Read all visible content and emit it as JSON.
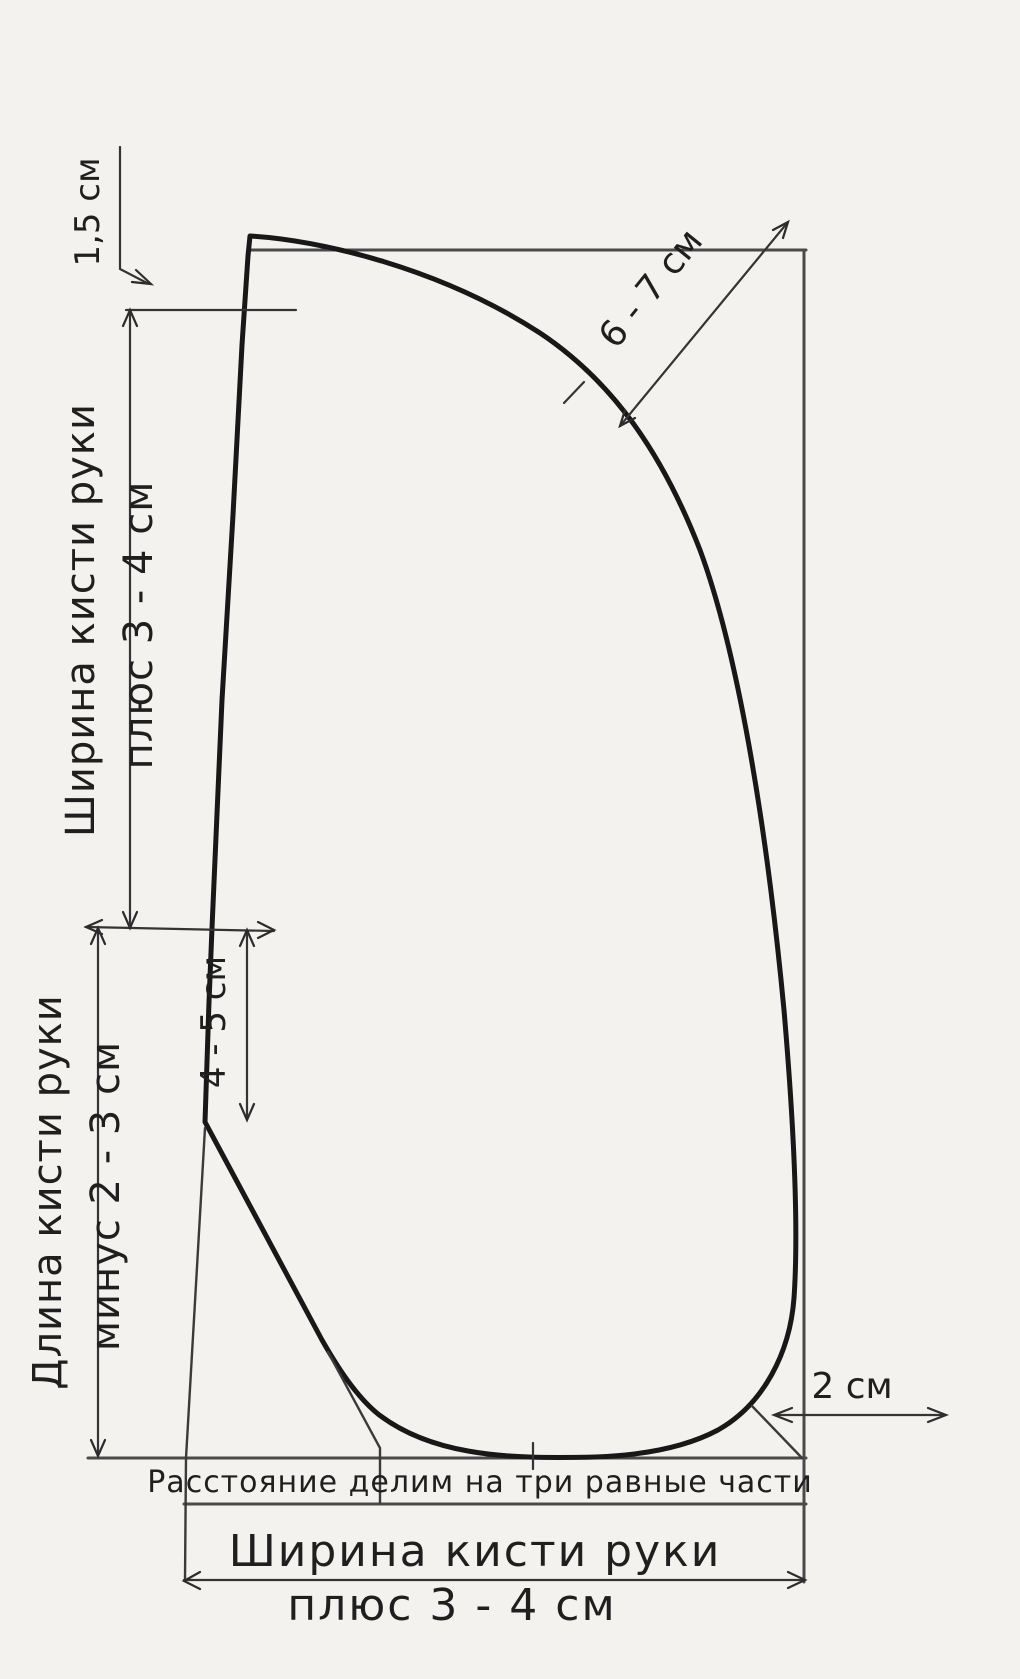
{
  "colors": {
    "background": "#f3f2ef",
    "pattern_outline": "#181818",
    "reference_lines": "#4a4a4a",
    "dimension_lines": "#343434",
    "text": "#1f1f1f"
  },
  "labels": {
    "offset_top": "1,5 см",
    "width_top": {
      "line1": "Ширина кисти руки",
      "line2": "плюс 3 - 4 см"
    },
    "corner_diagonal": "6 - 7 см",
    "notch_depth": "4 - 5 см",
    "hand_length": {
      "line1": "Длина кисти руки",
      "line2": "минус 2 - 3 см"
    },
    "corner_gap": "2 см",
    "divide_note": "Расстояние делим на три равные части",
    "width_bottom": {
      "line1": "Ширина кисти руки",
      "line2": "плюс 3 - 4 см"
    }
  }
}
